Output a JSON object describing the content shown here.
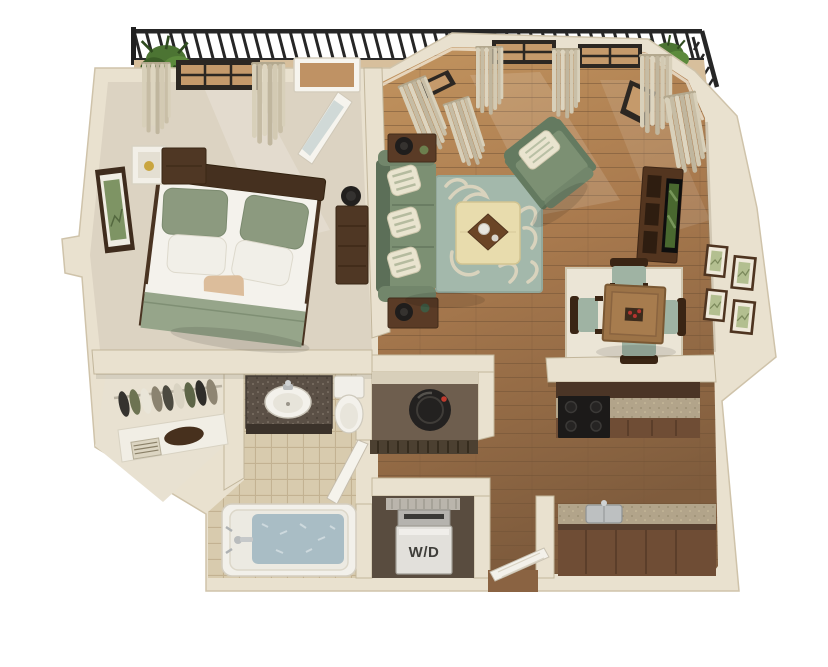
{
  "scene": {
    "type": "3D rendered floor plan",
    "unit": "one-bedroom one-bath apartment with balcony",
    "background": "#ffffff"
  },
  "labels": {
    "washer_dryer": "W/D"
  },
  "palette": {
    "wall": "#e9e1cf",
    "wall_shadow": "#b9ab90",
    "bedroom_carpet": "#dcd3c2",
    "wood_floor_light": "#c2945f",
    "wood_floor_dark": "#7f5c3d",
    "bath_tile": "#d8cbae",
    "dining_tile": "#ebe5d6",
    "rug_base": "#a3b8ab",
    "rug_pattern": "#d9d3bd",
    "upholstery_green": "#7c9073",
    "dark_wood": "#4f3724",
    "cabinet_wood": "#6f4d35",
    "countertop": "#b2a48a",
    "appliance_black": "#1c1a19",
    "fixture_white": "#f3f1eb",
    "tub_water": "#a9bdc5",
    "curtain": "#d8d0ba",
    "railing_black": "#262626",
    "plant_green": "#4e7a3a",
    "washer_body": "#e2e0db",
    "label_text": "#3f3e3a"
  },
  "rooms": [
    {
      "name": "balcony",
      "items": [
        "black railing",
        "potted plants",
        "round bistro table"
      ]
    },
    {
      "name": "bedroom",
      "items": [
        "bed with sage pillows",
        "nightstand",
        "white cube shelf",
        "dresser with lamp",
        "framed wall art",
        "curtained window",
        "open balcony door"
      ]
    },
    {
      "name": "living room",
      "items": [
        "sage sofa with striped pillows",
        "two end tables with lamps",
        "patterned area rug",
        "cream ottoman with tray",
        "sage armchair",
        "media console",
        "flat tv",
        "bay windows with curtains"
      ]
    },
    {
      "name": "dining area",
      "items": [
        "square wood table",
        "four chairs with sage cushions",
        "light tile inset",
        "four wall frames"
      ]
    },
    {
      "name": "kitchen",
      "items": [
        "black range",
        "speckled counters",
        "dark wood cabinets",
        "steel sink"
      ]
    },
    {
      "name": "bathroom",
      "items": [
        "granite vanity with sink",
        "toilet",
        "bathtub with water",
        "tile floor",
        "open door"
      ]
    },
    {
      "name": "closet",
      "items": [
        "hanging clothes",
        "white shelf",
        "duffel bag"
      ]
    },
    {
      "name": "utility closet",
      "items": [
        "round water heater",
        "louvered door"
      ]
    },
    {
      "name": "laundry closet",
      "items": [
        "washer dryer unit",
        "wire shelf"
      ]
    },
    {
      "name": "entry",
      "items": [
        "open front door"
      ]
    }
  ]
}
